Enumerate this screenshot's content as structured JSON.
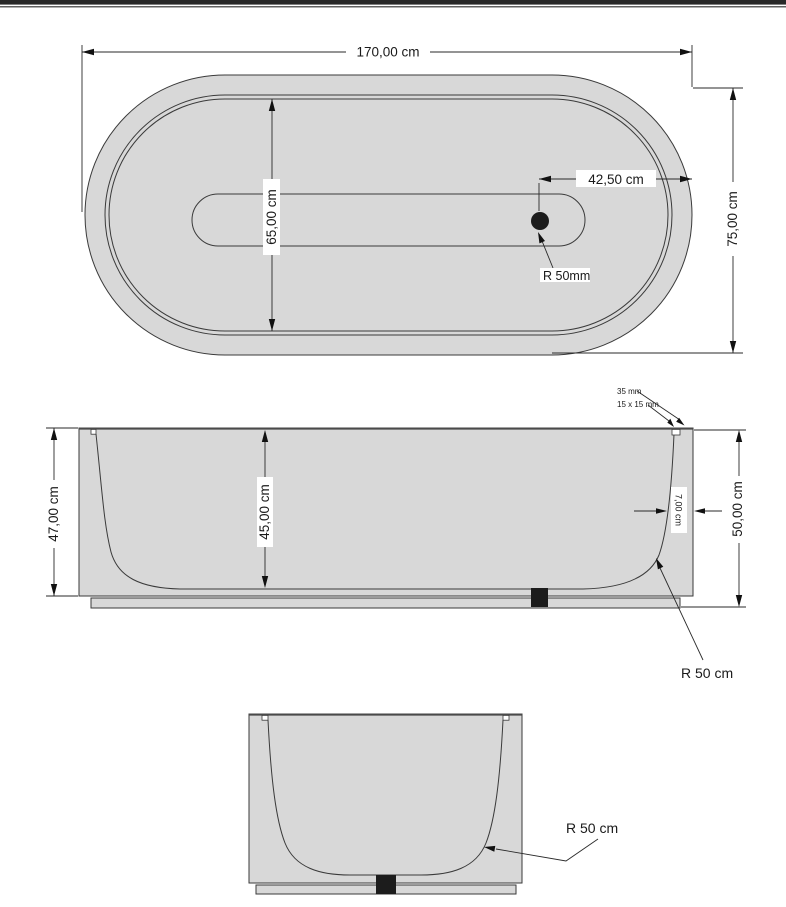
{
  "document": {
    "type": "technical-drawing",
    "subject": "freestanding oval bathtub, three orthographic views with dimensions"
  },
  "colors": {
    "body_fill": "#d8d8d8",
    "outline": "#3a3a3a",
    "dimension": "#1a1a1a",
    "drain": "#1c1c1c",
    "top_rule": "#282828",
    "background": "#ffffff"
  },
  "plan_view": {
    "overall_width": "170,00 cm",
    "basin_width": "65,00 cm",
    "drain_offset": "42,50 cm",
    "overall_depth": "75,00 cm",
    "drain_radius": "R 50mm"
  },
  "side_view": {
    "body_height": "47,00 cm",
    "basin_depth": "45,00 cm",
    "rim_width": "35 mm",
    "rim_notch": "15 x 15 mm",
    "wall_thickness": "7,00 cm",
    "total_height": "50,00 cm",
    "corner_radius": "R 50 cm"
  },
  "end_view": {
    "corner_radius": "R 50 cm"
  }
}
